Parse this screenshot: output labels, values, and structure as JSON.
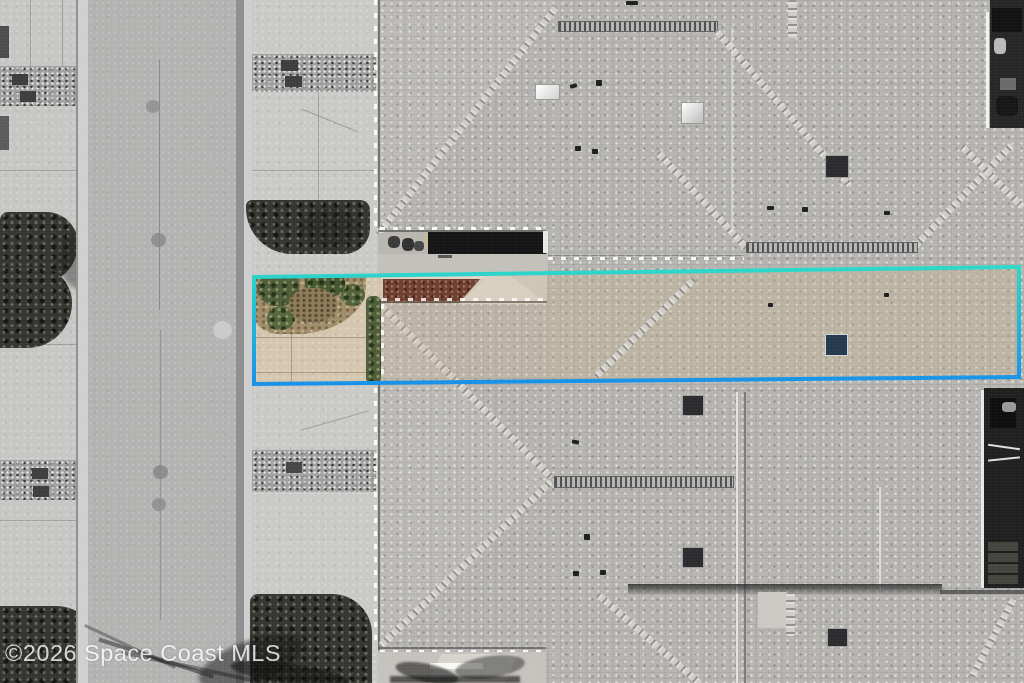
{
  "watermark": {
    "text": "©2026 Space Coast MLS"
  },
  "scene": {
    "type": "aerial-drone-photo",
    "subject": "townhome parcel highlighted in color over desaturated surroundings",
    "highlight": {
      "name": "property-boundary",
      "stroke_top": "#2BD8C8",
      "stroke_bottom": "#1690E8"
    }
  }
}
